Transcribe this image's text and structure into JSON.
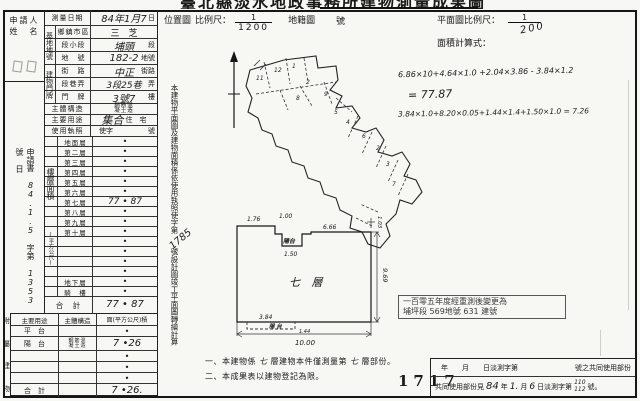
{
  "title": "臺北縣淡水地政事務所建物測量成果圖",
  "applicant": {
    "line1": "申請人",
    "line2": "姓　名"
  },
  "margin_note": {
    "p1": "申請書",
    "hw1": "84.1.5",
    "p2": "字第",
    "hw2": "1353",
    "p3": "號",
    "p4": "日"
  },
  "info": {
    "survey_date": {
      "label": "測量日期",
      "hw": "84年1月7",
      "suffix": "日"
    },
    "site_group": "基地地號",
    "township": {
      "label": "鄉鎮市區",
      "value": "三　芝"
    },
    "section": {
      "label": "段小段",
      "hw": "埔頭",
      "suffix": "段"
    },
    "lot": {
      "label": "地　號",
      "hw": "182-2",
      "suffix": "地號"
    },
    "addr_group": "建物門牌",
    "street": {
      "label": "街　路",
      "hw": "中正",
      "suffix": "街路"
    },
    "lane": {
      "label": "段巷弄",
      "hw": "3段25巷",
      "suffix": "弄"
    },
    "door": {
      "label": "門　牌",
      "hw": "3號7",
      "suffix": "樓"
    },
    "structure": {
      "label": "主體構造",
      "stamp1": "鋼筋混",
      "stamp2": "凝土造"
    },
    "use": {
      "label": "主要用途",
      "hw": "集合",
      "printed": "住　宅"
    },
    "license": {
      "label": "使用執照",
      "v1": "使字",
      "v2": "號"
    }
  },
  "floors": {
    "side_label": "樓層面積",
    "side_unit": "(平方公尺)",
    "rows": [
      {
        "label": "地面層",
        "value": "•"
      },
      {
        "label": "第二層",
        "value": "•"
      },
      {
        "label": "第三層",
        "value": "•"
      },
      {
        "label": "第四層",
        "value": "•"
      },
      {
        "label": "第五層",
        "value": "•"
      },
      {
        "label": "第六層",
        "value": "•"
      },
      {
        "label": "第七層",
        "value": "77 • 87"
      },
      {
        "label": "第八層",
        "value": "•"
      },
      {
        "label": "第九層",
        "value": "•"
      },
      {
        "label": "第十層",
        "value": "•"
      },
      {
        "label": "",
        "value": "•"
      },
      {
        "label": "",
        "value": "•"
      },
      {
        "label": "",
        "value": "•"
      },
      {
        "label": "",
        "value": "•"
      },
      {
        "label": "地下層",
        "value": "•"
      },
      {
        "label": "騎　樓",
        "value": "•"
      }
    ],
    "total_label": "合　計",
    "total_value": "77 • 87"
  },
  "annex": {
    "side_label": [
      "附",
      "屬",
      "建",
      "物"
    ],
    "header": {
      "use": "主要用途",
      "structure": "主體構造",
      "area": "面(平方公尺)積"
    },
    "rows": [
      {
        "use": "平　台",
        "area": "•"
      },
      {
        "use": "陽　台",
        "stamp1": "鋼筋混",
        "stamp2": "凝土造",
        "area": "7 •26"
      },
      {
        "use": "",
        "area": "•"
      },
      {
        "use": "",
        "area": "•"
      },
      {
        "use": "",
        "area": "•"
      }
    ],
    "total_label": "合　計",
    "total_area": "7 •26."
  },
  "mid_note": {
    "p1": "本建物平面圖及建物面積係依使用執照",
    "p2": "使字第",
    "hw": "1785",
    "p3": "號設計圖竣工平面圖轉繪計算"
  },
  "header_right": {
    "loc_label": "位置圖",
    "scale_label": "比例尺：",
    "loc_num": "1",
    "loc_den": "1200",
    "cad_label": "地籍圖",
    "cad_suffix": "號",
    "plan_scale_label": "平面圖比例尺：",
    "plan_num": "1",
    "plan_den": "200",
    "calc_label": "面積計算式："
  },
  "calc": {
    "line1": "6.86×10+4.64×1.0 +2.04×3.86 - 3.84×1.2",
    "line2": "= 77.87",
    "line3": "3.84×1.0+8.20×0.05+1.44×1.4+1.50×1.0 = 7.26"
  },
  "map": {
    "lots": [
      "11",
      "12",
      "1",
      "2",
      "8",
      "9",
      "5",
      "4",
      "6",
      "2",
      "3",
      "7"
    ]
  },
  "plan": {
    "room": "七 層",
    "balcony_top": "陽台",
    "balcony_bottom": "陽 台",
    "dims": {
      "top_left": "1.76",
      "top_mid": "1.00",
      "notch": "1.50",
      "top_right": "6.66",
      "right_small": "1.03",
      "right": "9.69",
      "bottom": "10.00",
      "bal": "3.84",
      "bal_small": "1.44"
    }
  },
  "stamp": {
    "line1": "一百零五年度經重測後變更為",
    "line2": "埔坪段 569地號 631 建號"
  },
  "notes": {
    "n1a": "一、本建物係",
    "n1hw1": "七",
    "n1b": "層建物本件僅測量第",
    "n1hw2": "七",
    "n1c": "層部份。",
    "n2": "二、本成果表以建物登記為限。",
    "serial": "1717"
  },
  "footer": {
    "r1a": "年　　月　　日淡測字第",
    "r1b": "號之共同使用部份",
    "r2a": "共同使用部份見",
    "hw_y": "84",
    "r2b": "年",
    "hw_m": "1.",
    "r2c": "月",
    "hw_d": "6",
    "r2d": "日淡測字第",
    "hw_n1": "110",
    "hw_n2": "112",
    "r2e": "號。"
  }
}
